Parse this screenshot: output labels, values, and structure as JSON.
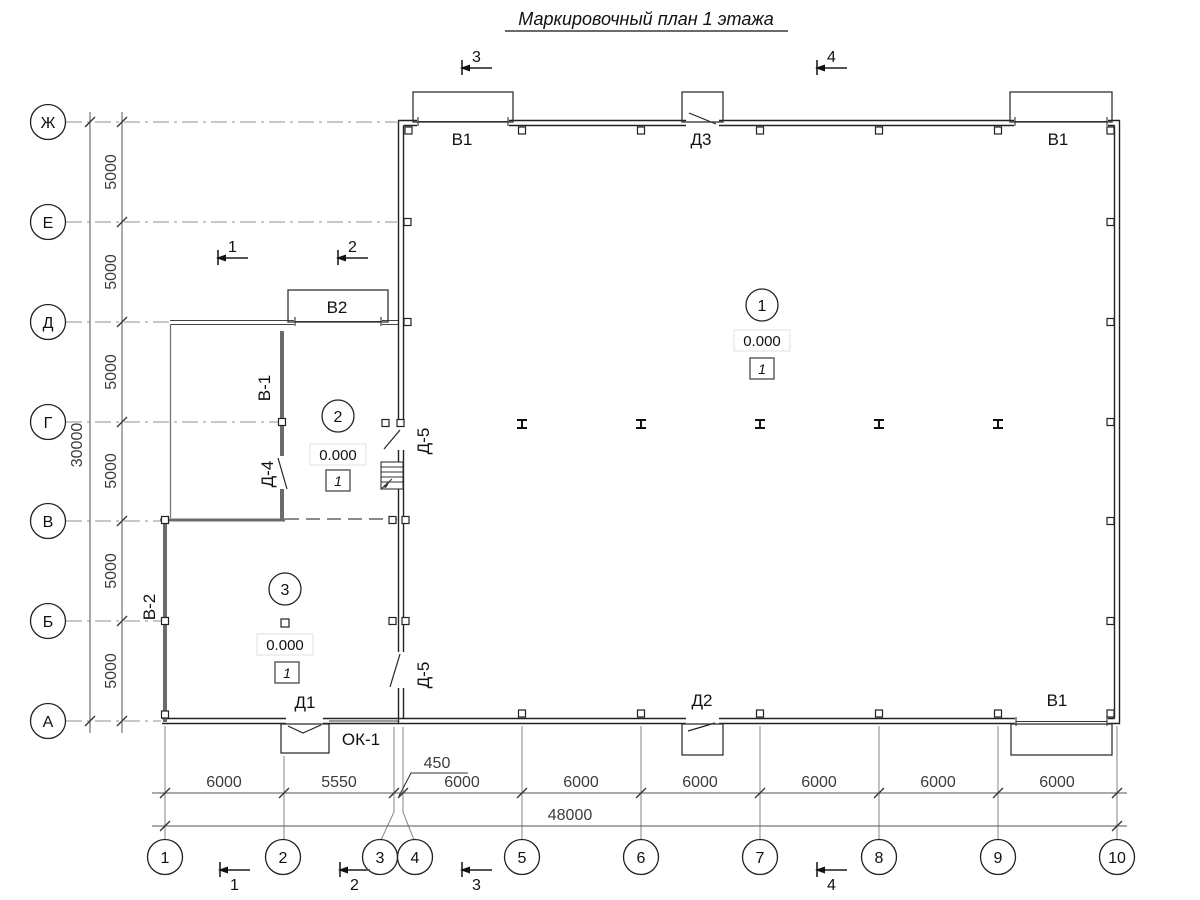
{
  "title": "Маркировочный план 1 этажа",
  "axes": {
    "rows": [
      "Ж",
      "Е",
      "Д",
      "Г",
      "В",
      "Б",
      "А"
    ],
    "cols": [
      "1",
      "2",
      "3",
      "4",
      "5",
      "6",
      "7",
      "8",
      "9",
      "10"
    ]
  },
  "dims": {
    "left_total": "30000",
    "left_segments": [
      "5000",
      "5000",
      "5000",
      "5000",
      "5000",
      "5000"
    ],
    "bottom_total": "48000",
    "bottom_segments": [
      "6000",
      "5550",
      "6000",
      "6000",
      "6000",
      "6000",
      "6000",
      "6000"
    ],
    "offset": "450"
  },
  "sections": {
    "s1": "1",
    "s2": "2",
    "s3": "3",
    "s4": "4"
  },
  "openings": {
    "gate_top_left": "В1",
    "door_top": "Д3",
    "gate_top_right": "В1",
    "gate_vestibule": "В2",
    "wall_upper": "В-1",
    "door_inner_upper": "Д-4",
    "door_hall_upper": "Д-5",
    "door_hall_lower": "Д-5",
    "wall_left": "В-2",
    "door_bottom_left": "Д1",
    "window_bottom": "ОК-1",
    "door_bottom_mid": "Д2",
    "gate_bottom_right": "В1"
  },
  "rooms": [
    {
      "number": "1",
      "elevation": "0.000",
      "finish": "1"
    },
    {
      "number": "2",
      "elevation": "0.000",
      "finish": "1"
    },
    {
      "number": "3",
      "elevation": "0.000",
      "finish": "1"
    }
  ]
}
